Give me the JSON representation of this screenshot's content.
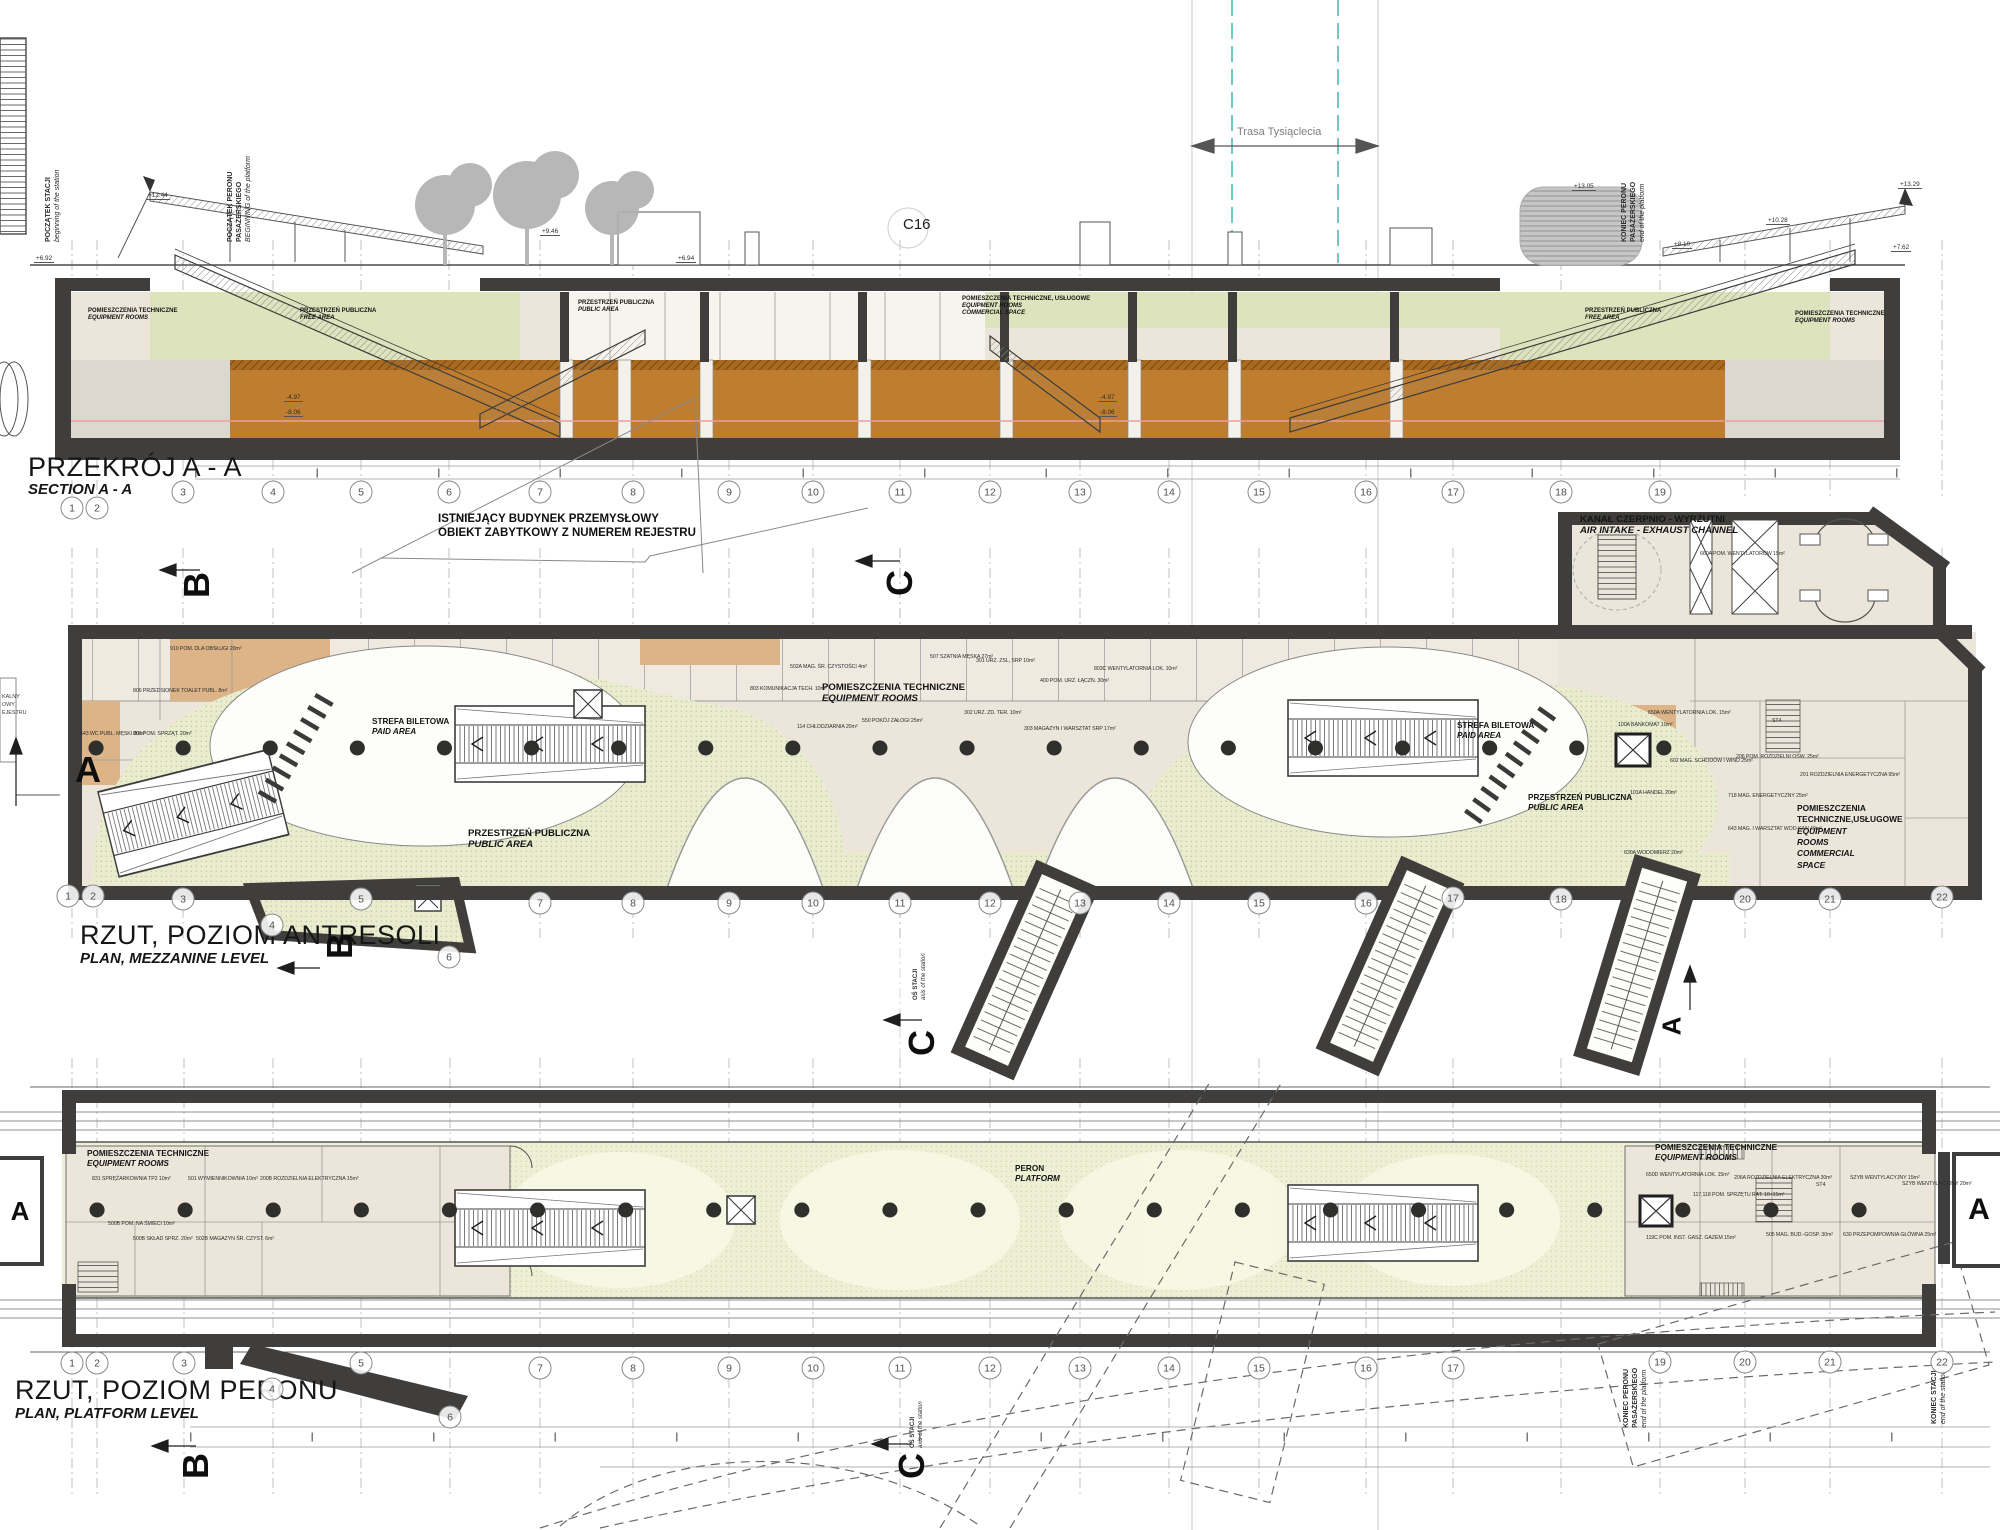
{
  "drawing": {
    "code": "C16",
    "road_label": "Trasa Tysiąclecia"
  },
  "markers": {
    "a": "A",
    "b": "B",
    "c": "C"
  },
  "axis": {
    "pl": "OŚ STACJI",
    "en": "axis of the station"
  },
  "section": {
    "title": {
      "pl": "PRZEKRÓJ A - A",
      "en": "SECTION A - A"
    },
    "labels": {
      "rooms": {
        "pl": "POMIESZCZENIA TECHNICZNE",
        "en": "EQUIPMENT ROOMS"
      },
      "free": {
        "pl": "PRZESTRZEŃ PUBLICZNA",
        "en": "FREE AREA"
      },
      "public": {
        "pl": "PRZESTRZEŃ PUBLICZNA",
        "en": "PUBLIC AREA"
      },
      "center": {
        "pl": "POMIESZCZENIA TECHNICZNE, USŁUGOWE",
        "en": "EQUIPMENT ROOMS",
        "en2": "COMMERCIAL SPACE"
      }
    },
    "edge": {
      "start_station": {
        "l1": "POCZĄTEK STACJI",
        "l2": "beginning of the station"
      },
      "start_platform": {
        "l1": "POCZĄTEK PERONU",
        "l2": "PASAŻERSKIEGO",
        "l3": "BEGINNING of the platform"
      },
      "end_platform": {
        "l1": "KONIEC PERONU",
        "l2": "PASAŻERSKIEGO",
        "l3": "end of the platform"
      }
    },
    "elevations": [
      {
        "t": "+12.44",
        "x": 146,
        "y": 192
      },
      {
        "t": "+9.46",
        "x": 540,
        "y": 228
      },
      {
        "t": "+6.92",
        "x": 34,
        "y": 255
      },
      {
        "t": "+6.94",
        "x": 676,
        "y": 255
      },
      {
        "t": "-4.97",
        "x": 284,
        "y": 394
      },
      {
        "t": "-8.06",
        "x": 284,
        "y": 409
      },
      {
        "t": "-4.97",
        "x": 1098,
        "y": 394
      },
      {
        "t": "-8.06",
        "x": 1098,
        "y": 409
      },
      {
        "t": "+13.05",
        "x": 1572,
        "y": 183
      },
      {
        "t": "+10.28",
        "x": 1766,
        "y": 217
      },
      {
        "t": "+8.10",
        "x": 1672,
        "y": 241
      },
      {
        "t": "+13.29",
        "x": 1898,
        "y": 181
      },
      {
        "t": "+7.62",
        "x": 1891,
        "y": 244
      }
    ]
  },
  "mezzanine": {
    "title": {
      "pl": "RZUT, POZIOM ANTRESOLI",
      "en": "PLAN, MEZZANINE LEVEL"
    },
    "note": {
      "l1": "ISTNIEJĄCY BUDYNEK PRZEMYSŁOWY",
      "l2": "OBIEKT ZABYTKOWY Z NUMEREM REJESTRU"
    },
    "labels": {
      "kanal": {
        "pl": "KANAŁ CZERPNIO - WYRZUTNI",
        "en": "AIR INTAKE - EXHAUST CHANNEL"
      },
      "equipment": {
        "pl": "POMIESZCZENIA TECHNICZNE",
        "en": "EQUIPMENT ROOMS"
      },
      "paid": {
        "pl": "STREFA BILETOWA",
        "en": "PAID AREA"
      },
      "public": {
        "pl": "PRZESTRZEŃ PUBLICZNA",
        "en": "PUBLIC AREA"
      },
      "commercial": {
        "l1": "POMIESZCZENIA",
        "l2": "TECHNICZNE,USŁUGOWE",
        "l3": "EQUIPMENT",
        "l4": "ROOMS",
        "l5": "COMMERCIAL",
        "l6": "SPACE"
      }
    },
    "room_tags": [
      {
        "t": "643 WC PUBL. MĘSKI 20m²",
        "x": 80,
        "y": 731
      },
      {
        "t": "801 POM. SPRZĄT. 20m²",
        "x": 133,
        "y": 731
      },
      {
        "t": "910 POM. DLA OBSŁUGI 20m²",
        "x": 170,
        "y": 646
      },
      {
        "t": "806 PRZEDSIONEK TOALET PUBL. 8m²",
        "x": 133,
        "y": 688
      },
      {
        "t": "803 KOMUNIKACJA TECH. 10m²",
        "x": 750,
        "y": 686
      },
      {
        "t": "502A MAG. ŚR. CZYSTOŚCI 4m²",
        "x": 790,
        "y": 664
      },
      {
        "t": "507 SZATNIA MĘSKA 27m²",
        "x": 930,
        "y": 654
      },
      {
        "t": "301 URZ. ZSL, SRP 10m²",
        "x": 976,
        "y": 658
      },
      {
        "t": "400 POM. URZ. ŁĄCZN. 30m²",
        "x": 1040,
        "y": 678
      },
      {
        "t": "114 CHŁODZIARNIA 20m²",
        "x": 797,
        "y": 724
      },
      {
        "t": "550 POKÓJ ZAŁOGI 25m²",
        "x": 862,
        "y": 718
      },
      {
        "t": "302 URZ. ZD. TER. 10m²",
        "x": 964,
        "y": 710
      },
      {
        "t": "303 MAGAZYN I WARSZTAT SRP 17m²",
        "x": 1024,
        "y": 726
      },
      {
        "t": "803C WENTYLATORNIA LOK. 10m²",
        "x": 1094,
        "y": 666
      },
      {
        "t": "660A POM. WENTYLATORÓW 15m²",
        "x": 1700,
        "y": 551
      },
      {
        "t": "650A WENTYLATORNIA LOK. 15m²",
        "x": 1648,
        "y": 710
      },
      {
        "t": "100A BANKOMAT 10m²",
        "x": 1618,
        "y": 722
      },
      {
        "t": "602 MAG. SCHODÓW I WIND 25m²",
        "x": 1670,
        "y": 758
      },
      {
        "t": "206 POM. ROZDZIELNI OŚW. 25m²",
        "x": 1736,
        "y": 754
      },
      {
        "t": "201 ROZDZIELNIA ENERGETYCZNA 95m²",
        "x": 1800,
        "y": 772
      },
      {
        "t": "718 MAG. ENERGETYCZNY 25m²",
        "x": 1728,
        "y": 793
      },
      {
        "t": "643 MAG. I WARSZTAT WOD-KAN 40m²",
        "x": 1728,
        "y": 826
      },
      {
        "t": "101A HANDEL 20m²",
        "x": 1630,
        "y": 790
      },
      {
        "t": "630A WODOMIERZ 20m²",
        "x": 1624,
        "y": 850
      },
      {
        "t": "ST4",
        "x": 1772,
        "y": 718
      }
    ],
    "fragments": [
      {
        "t": "KALNY",
        "x": 2,
        "y": 694
      },
      {
        "t": "OWY",
        "x": 2,
        "y": 702
      },
      {
        "t": "EJESTRU",
        "x": 2,
        "y": 710
      }
    ]
  },
  "platform": {
    "title": {
      "pl": "RZUT, POZIOM PERONU",
      "en": "PLAN, PLATFORM LEVEL"
    },
    "labels": {
      "equipment": {
        "pl": "POMIESZCZENIA TECHNICZNE",
        "en": "EQUIPMENT ROOMS"
      },
      "peron": {
        "pl": "PERON",
        "en": "PLATFORM"
      }
    },
    "edge": {
      "end_platform": {
        "l1": "KONIEC PERONU",
        "l2": "PASAŻERSKIEGO",
        "l3": "end of the platform"
      },
      "end_station": {
        "l1": "KONIEC STACJI",
        "l2": "end of the station"
      }
    },
    "room_tags": [
      {
        "t": "831 SPRĘŻARKOWNIA TP2 10m²",
        "x": 92,
        "y": 1176
      },
      {
        "t": "501 WYMIENNIKOWNIA 10m²",
        "x": 188,
        "y": 1176
      },
      {
        "t": "200B ROZDZIELNIA ELEKTRYCZNA 15m²",
        "x": 260,
        "y": 1176
      },
      {
        "t": "500B POM. NA ŚMIECI 10m²",
        "x": 108,
        "y": 1221
      },
      {
        "t": "500B SKŁAD SPRZ. 20m²",
        "x": 133,
        "y": 1236
      },
      {
        "t": "502B MAGAZYN ŚR. CZYST. 6m²",
        "x": 196,
        "y": 1236
      },
      {
        "t": "650D WENTYLATORNIA LOK. 15m²",
        "x": 1646,
        "y": 1172
      },
      {
        "t": "206A ROZDZIELNIA ELEKTRYCZNA 30m²",
        "x": 1734,
        "y": 1175
      },
      {
        "t": "117,118 POM. SPRZĘTU RAT. 10+15m²",
        "x": 1693,
        "y": 1192
      },
      {
        "t": "SZYB WENTYLACYJNY 15m²",
        "x": 1850,
        "y": 1175
      },
      {
        "t": "SZYB WENTYLACYJNY 20m²",
        "x": 1902,
        "y": 1181
      },
      {
        "t": "119C POM. INST. GASZ. GAZEM 15m²",
        "x": 1646,
        "y": 1235
      },
      {
        "t": "505 MAG. BUD.-GOSP. 30m²",
        "x": 1766,
        "y": 1232
      },
      {
        "t": "630 PRZEPOMPOWNIA GŁÓWNA 25m²",
        "x": 1843,
        "y": 1232
      },
      {
        "t": "ST4",
        "x": 1816,
        "y": 1182
      }
    ]
  },
  "grids": {
    "section": [
      {
        "n": "1",
        "x": 72,
        "y": 508
      },
      {
        "n": "2",
        "x": 97,
        "y": 508
      },
      {
        "n": "3",
        "x": 183,
        "y": 492
      },
      {
        "n": "4",
        "x": 273,
        "y": 492
      },
      {
        "n": "5",
        "x": 361,
        "y": 492
      },
      {
        "n": "6",
        "x": 449,
        "y": 492
      },
      {
        "n": "7",
        "x": 540,
        "y": 492
      },
      {
        "n": "8",
        "x": 633,
        "y": 492
      },
      {
        "n": "9",
        "x": 729,
        "y": 492
      },
      {
        "n": "10",
        "x": 813,
        "y": 492
      },
      {
        "n": "11",
        "x": 900,
        "y": 492
      },
      {
        "n": "12",
        "x": 990,
        "y": 492
      },
      {
        "n": "13",
        "x": 1080,
        "y": 492
      },
      {
        "n": "14",
        "x": 1169,
        "y": 492
      },
      {
        "n": "15",
        "x": 1259,
        "y": 492
      },
      {
        "n": "16",
        "x": 1366,
        "y": 492
      },
      {
        "n": "17",
        "x": 1453,
        "y": 492
      },
      {
        "n": "18",
        "x": 1561,
        "y": 492
      },
      {
        "n": "19",
        "x": 1660,
        "y": 492
      }
    ],
    "mezzanine": [
      {
        "n": "1",
        "x": 68,
        "y": 896
      },
      {
        "n": "2",
        "x": 93,
        "y": 896
      },
      {
        "n": "3",
        "x": 183,
        "y": 899
      },
      {
        "n": "4",
        "x": 272,
        "y": 925
      },
      {
        "n": "5",
        "x": 361,
        "y": 899
      },
      {
        "n": "6",
        "x": 449,
        "y": 957
      },
      {
        "n": "7",
        "x": 540,
        "y": 903
      },
      {
        "n": "8",
        "x": 633,
        "y": 903
      },
      {
        "n": "9",
        "x": 729,
        "y": 903
      },
      {
        "n": "10",
        "x": 813,
        "y": 903
      },
      {
        "n": "11",
        "x": 900,
        "y": 903
      },
      {
        "n": "12",
        "x": 990,
        "y": 903
      },
      {
        "n": "13",
        "x": 1080,
        "y": 903
      },
      {
        "n": "14",
        "x": 1169,
        "y": 903
      },
      {
        "n": "15",
        "x": 1259,
        "y": 903
      },
      {
        "n": "16",
        "x": 1366,
        "y": 903
      },
      {
        "n": "17",
        "x": 1453,
        "y": 898
      },
      {
        "n": "18",
        "x": 1561,
        "y": 899
      },
      {
        "n": "20",
        "x": 1745,
        "y": 899
      },
      {
        "n": "21",
        "x": 1830,
        "y": 899
      },
      {
        "n": "22",
        "x": 1942,
        "y": 897
      }
    ],
    "platform": [
      {
        "n": "1",
        "x": 72,
        "y": 1363
      },
      {
        "n": "2",
        "x": 97,
        "y": 1363
      },
      {
        "n": "3",
        "x": 184,
        "y": 1363
      },
      {
        "n": "4",
        "x": 272,
        "y": 1389
      },
      {
        "n": "5",
        "x": 361,
        "y": 1363
      },
      {
        "n": "6",
        "x": 450,
        "y": 1417
      },
      {
        "n": "7",
        "x": 540,
        "y": 1368
      },
      {
        "n": "8",
        "x": 633,
        "y": 1368
      },
      {
        "n": "9",
        "x": 729,
        "y": 1368
      },
      {
        "n": "10",
        "x": 813,
        "y": 1368
      },
      {
        "n": "11",
        "x": 900,
        "y": 1368
      },
      {
        "n": "12",
        "x": 990,
        "y": 1368
      },
      {
        "n": "13",
        "x": 1080,
        "y": 1368
      },
      {
        "n": "14",
        "x": 1169,
        "y": 1368
      },
      {
        "n": "15",
        "x": 1259,
        "y": 1368
      },
      {
        "n": "16",
        "x": 1366,
        "y": 1368
      },
      {
        "n": "17",
        "x": 1453,
        "y": 1368
      },
      {
        "n": "19",
        "x": 1660,
        "y": 1362
      },
      {
        "n": "20",
        "x": 1745,
        "y": 1362
      },
      {
        "n": "21",
        "x": 1830,
        "y": 1362
      },
      {
        "n": "22",
        "x": 1942,
        "y": 1362
      }
    ]
  }
}
